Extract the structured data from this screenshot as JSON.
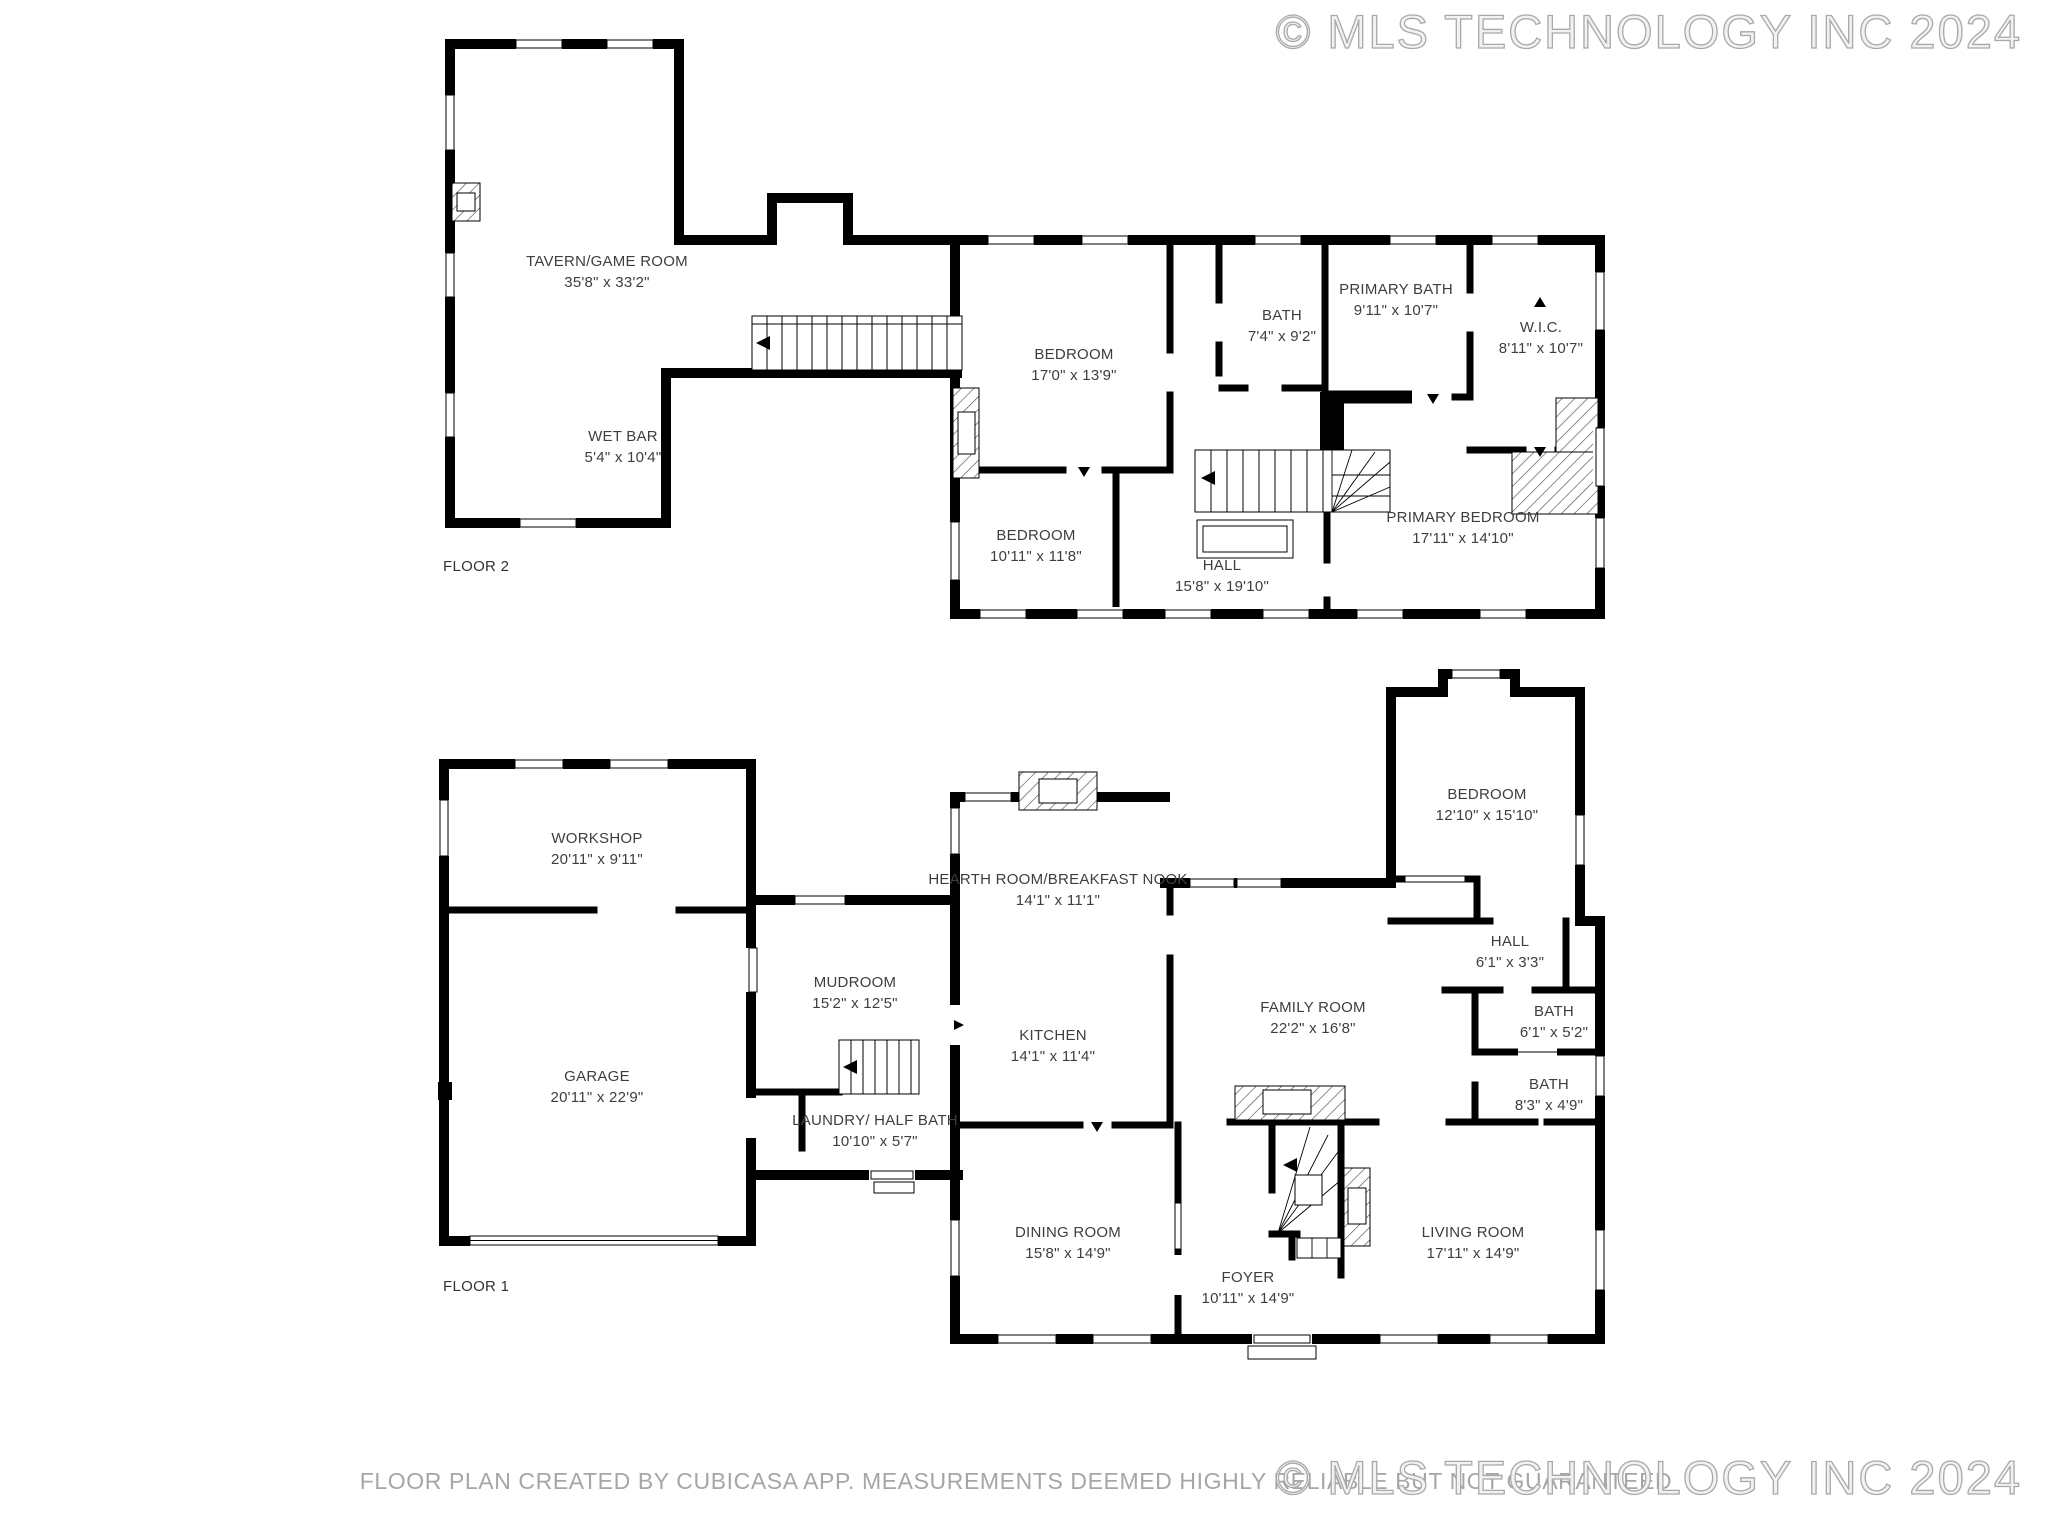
{
  "watermark": {
    "text": "© MLS TECHNOLOGY INC 2024"
  },
  "footer": {
    "disclaimer": "FLOOR PLAN CREATED BY CUBICASA APP. MEASUREMENTS DEEMED HIGHLY RELIABLE BUT NOT GUARANTEED"
  },
  "floors": [
    {
      "label": "FLOOR 2"
    },
    {
      "label": "FLOOR 1"
    }
  ],
  "colors": {
    "wall": "#000000",
    "label": "#3e3e3e",
    "muted": "#a6a6a6",
    "watermark_stroke": "#a9a9a9"
  },
  "rooms": [
    {
      "floor": "FLOOR 2",
      "name": "TAVERN/GAME ROOM",
      "dims": "35'8\" x 33'2\""
    },
    {
      "floor": "FLOOR 2",
      "name": "WET BAR",
      "dims": "5'4\" x 10'4\""
    },
    {
      "floor": "FLOOR 2",
      "name": "BEDROOM",
      "dims": "17'0\" x 13'9\""
    },
    {
      "floor": "FLOOR 2",
      "name": "BATH",
      "dims": "7'4\" x 9'2\""
    },
    {
      "floor": "FLOOR 2",
      "name": "PRIMARY BATH",
      "dims": "9'11\" x 10'7\""
    },
    {
      "floor": "FLOOR 2",
      "name": "W.I.C.",
      "dims": "8'11\" x 10'7\""
    },
    {
      "floor": "FLOOR 2",
      "name": "BEDROOM",
      "dims": "10'11\" x 11'8\""
    },
    {
      "floor": "FLOOR 2",
      "name": "HALL",
      "dims": "15'8\" x 19'10\""
    },
    {
      "floor": "FLOOR 2",
      "name": "PRIMARY BEDROOM",
      "dims": "17'11\" x 14'10\""
    },
    {
      "floor": "FLOOR 1",
      "name": "WORKSHOP",
      "dims": "20'11\" x 9'11\""
    },
    {
      "floor": "FLOOR 1",
      "name": "GARAGE",
      "dims": "20'11\" x 22'9\""
    },
    {
      "floor": "FLOOR 1",
      "name": "MUDROOM",
      "dims": "15'2\" x 12'5\""
    },
    {
      "floor": "FLOOR 1",
      "name": "LAUNDRY/ HALF BATH",
      "dims": "10'10\" x 5'7\""
    },
    {
      "floor": "FLOOR 1",
      "name": "HEARTH ROOM/BREAKFAST NOOK",
      "dims": "14'1\" x 11'1\""
    },
    {
      "floor": "FLOOR 1",
      "name": "KITCHEN",
      "dims": "14'1\" x 11'4\""
    },
    {
      "floor": "FLOOR 1",
      "name": "FAMILY ROOM",
      "dims": "22'2\" x 16'8\""
    },
    {
      "floor": "FLOOR 1",
      "name": "BEDROOM",
      "dims": "12'10\" x 15'10\""
    },
    {
      "floor": "FLOOR 1",
      "name": "HALL",
      "dims": "6'1\" x 3'3\""
    },
    {
      "floor": "FLOOR 1",
      "name": "BATH",
      "dims": "6'1\" x 5'2\""
    },
    {
      "floor": "FLOOR 1",
      "name": "BATH",
      "dims": "8'3\" x 4'9\""
    },
    {
      "floor": "FLOOR 1",
      "name": "DINING ROOM",
      "dims": "15'8\" x 14'9\""
    },
    {
      "floor": "FLOOR 1",
      "name": "FOYER",
      "dims": "10'11\" x 14'9\""
    },
    {
      "floor": "FLOOR 1",
      "name": "LIVING ROOM",
      "dims": "17'11\" x 14'9\""
    }
  ]
}
